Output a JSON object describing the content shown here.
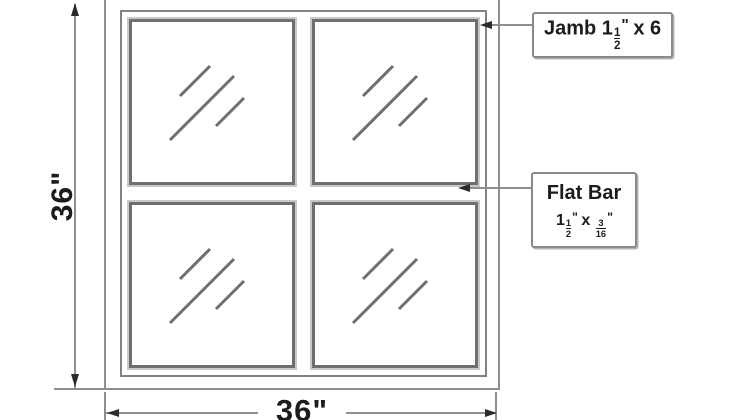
{
  "drawing": {
    "type": "window-shop-drawing",
    "panes": 4
  },
  "dimensions": {
    "height_label": "36\"",
    "width_label": "36\""
  },
  "callouts": {
    "jamb": {
      "prefix": "Jamb 1",
      "frac": {
        "num": "1",
        "den": "2"
      },
      "unit": "\"",
      "suffix": " x 6"
    },
    "flat_bar": {
      "title": "Flat Bar",
      "spec_prefix": "1",
      "frac1": {
        "num": "1",
        "den": "2"
      },
      "unit1": "\"",
      "mid": " x ",
      "frac2": {
        "num": "3",
        "den": "16"
      },
      "unit2": "\""
    }
  },
  "colors": {
    "background": "#ffffff",
    "dim_line": "#8f8f8f",
    "frame_dark": "#6f6f6f",
    "frame_bevel": "#c8c8c8",
    "arrow": "#2b2b2b",
    "text": "#1c1c1c",
    "callout_border": "#8a8a8a"
  }
}
